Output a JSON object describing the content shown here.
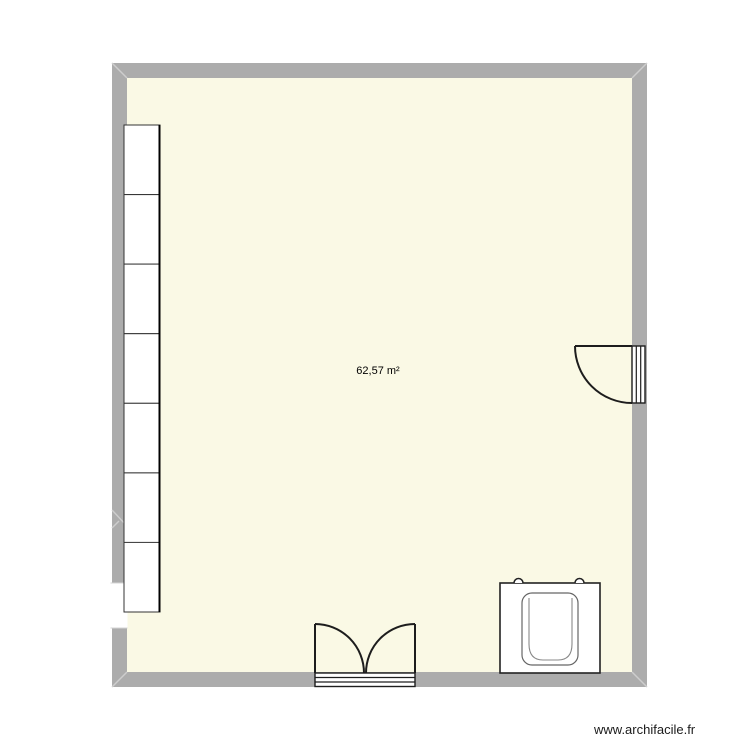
{
  "room": {
    "area_label": "62,57 m²",
    "floor_color": "#faf9e5",
    "wall_color": "#acacac"
  },
  "furniture": {
    "cabinets": {
      "count": 7
    },
    "objects": [
      "cabinet-column",
      "window",
      "single-swing-door",
      "double-swing-door",
      "bathtub"
    ]
  },
  "watermark": {
    "text": "www.archifacile.fr"
  }
}
